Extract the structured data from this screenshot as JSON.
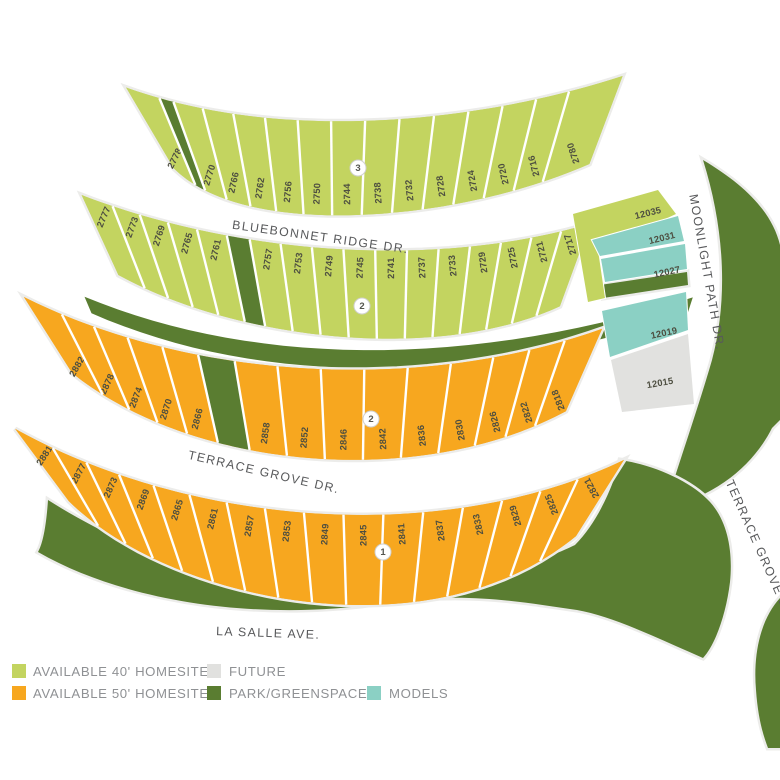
{
  "title": "community-site-map",
  "colors": {
    "lot40": "#c3d460",
    "lot50": "#f7a71f",
    "park": "#5a7d31",
    "model": "#8bd0c4",
    "future": "#e1e1df",
    "roadHalo": "#ececea",
    "divider": "#ffffff",
    "lotText": "#4d4e40",
    "streetText": "#58595b",
    "legendText": "#8f9194",
    "markerFill": "#ffffff",
    "markerStroke": "#d0d0ce",
    "markerText": "#55564f"
  },
  "rows": [
    {
      "name": "row-bluebonnet-north",
      "fillKey": "lot40",
      "halfwidth": 47,
      "labelOffset": 0.55,
      "centerline": [
        [
          150,
          128
        ],
        [
          255,
          190
        ],
        [
          460,
          175
        ],
        [
          606,
          120
        ]
      ],
      "slices": [
        {
          "lot": "2778",
          "w": 1.25
        },
        {
          "park": true,
          "w": 0.5
        },
        {
          "lot": "2770",
          "w": 1
        },
        {
          "lot": "2766",
          "w": 1
        },
        {
          "lot": "2762",
          "w": 1
        },
        {
          "lot": "2756",
          "w": 1
        },
        {
          "lot": "2750",
          "w": 1
        },
        {
          "lot": "2744",
          "w": 1
        },
        {
          "lot": "2738",
          "w": 1
        },
        {
          "lot": "2732",
          "w": 1
        },
        {
          "lot": "2728",
          "w": 1
        },
        {
          "lot": "2724",
          "w": 1
        },
        {
          "lot": "2720",
          "w": 1
        },
        {
          "lot": "2716",
          "w": 1
        },
        {
          "lot": "2780",
          "w": 1.7
        }
      ]
    },
    {
      "name": "row-bluebonnet-south",
      "fillKey": "lot40",
      "halfwidth": 44,
      "labelOffset": -0.6,
      "centerline": [
        [
          100,
          235
        ],
        [
          230,
          295
        ],
        [
          430,
          318
        ],
        [
          575,
          265
        ]
      ],
      "slices": [
        {
          "lot": "2777",
          "w": 1.2
        },
        {
          "lot": "2773",
          "w": 1
        },
        {
          "lot": "2769",
          "w": 1
        },
        {
          "lot": "2765",
          "w": 1
        },
        {
          "lot": "2761",
          "w": 1
        },
        {
          "park": true,
          "w": 0.75
        },
        {
          "lot": "2757",
          "w": 1
        },
        {
          "lot": "2753",
          "w": 1
        },
        {
          "lot": "2749",
          "w": 1
        },
        {
          "lot": "2745",
          "w": 1
        },
        {
          "lot": "2741",
          "w": 1
        },
        {
          "lot": "2737",
          "w": 1
        },
        {
          "lot": "2733",
          "w": 1
        },
        {
          "lot": "2729",
          "w": 1
        },
        {
          "lot": "2725",
          "w": 1
        },
        {
          "lot": "2721",
          "w": 1
        },
        {
          "lot": "2717",
          "w": 1
        }
      ]
    },
    {
      "name": "row-terrace-north",
      "fillKey": "lot50",
      "halfwidth": 45,
      "labelOffset": 0.55,
      "centerline": [
        [
          48,
          335
        ],
        [
          190,
          425
        ],
        [
          420,
          442
        ],
        [
          584,
          370
        ]
      ],
      "slices": [
        {
          "lot": "2882",
          "w": 1.25
        },
        {
          "lot": "2878",
          "w": 1
        },
        {
          "lot": "2874",
          "w": 1
        },
        {
          "lot": "2870",
          "w": 1
        },
        {
          "lot": "2866",
          "w": 1
        },
        {
          "park": true,
          "w": 1.0
        },
        {
          "lot": "2858",
          "w": 1.15
        },
        {
          "lot": "2852",
          "w": 1.15
        },
        {
          "lot": "2846",
          "w": 1.15
        },
        {
          "lot": "2842",
          "w": 1.15
        },
        {
          "lot": "2836",
          "w": 1.15
        },
        {
          "lot": "2830",
          "w": 1.15
        },
        {
          "lot": "2826",
          "w": 1
        },
        {
          "lot": "2822",
          "w": 1
        },
        {
          "lot": "2818",
          "w": 1.1
        }
      ]
    },
    {
      "name": "row-terrace-south",
      "fillKey": "lot50",
      "halfwidth": 45,
      "labelOffset": -0.55,
      "centerline": [
        [
          42,
          465
        ],
        [
          170,
          560
        ],
        [
          430,
          605
        ],
        [
          600,
          498
        ]
      ],
      "slices": [
        {
          "lot": "2881",
          "w": 1.35
        },
        {
          "lot": "2877",
          "w": 1.1
        },
        {
          "lot": "2873",
          "w": 1
        },
        {
          "lot": "2869",
          "w": 1
        },
        {
          "lot": "2865",
          "w": 1
        },
        {
          "lot": "2861",
          "w": 1
        },
        {
          "lot": "2857",
          "w": 1
        },
        {
          "lot": "2853",
          "w": 1
        },
        {
          "lot": "2849",
          "w": 1
        },
        {
          "lot": "2845",
          "w": 1
        },
        {
          "lot": "2841",
          "w": 1
        },
        {
          "lot": "2837",
          "w": 1
        },
        {
          "lot": "2833",
          "w": 1
        },
        {
          "lot": "2829",
          "w": 1
        },
        {
          "lot": "2825",
          "w": 1
        },
        {
          "lot": "2821",
          "w": 1.3
        }
      ]
    }
  ],
  "greenStrip": {
    "halfwidth": 9,
    "centerline": [
      [
        88,
        305
      ],
      [
        250,
        374
      ],
      [
        460,
        380
      ],
      [
        690,
        306
      ]
    ]
  },
  "parks": [
    {
      "name": "park-moonlight-east",
      "d": "M703,160 C725,230 728,300 712,360 C700,402 680,460 665,508 C720,495 755,462 772,428 L780,420 L780,245 C772,212 745,185 703,160 Z"
    },
    {
      "name": "park-south-greenbelt",
      "d": "M48,500 C150,565 280,602 400,592 C480,582 540,562 575,545 C600,520 615,480 620,460 C655,465 692,482 710,502 C728,522 733,552 730,582 C726,615 715,645 703,658 C655,637 612,616 577,610 C520,602 470,592 390,602 C270,622 130,605 38,552 C42,545 46,530 48,500 Z"
    },
    {
      "name": "park-east-edge-sliver",
      "d": "M780,598 C760,620 753,655 756,690 C758,718 763,735 768,748 L780,748 Z"
    },
    {
      "name": "park-strip-models-block",
      "d": "M600,285 L687,272 L688,285 L603,298 Z"
    }
  ],
  "rightBlock": [
    {
      "id": "12035",
      "typeKey": "lot40",
      "points": "573,214 658,190 676,214 598,250 605,298 588,302",
      "label": {
        "x": 648,
        "y": 213,
        "rot": -14
      }
    },
    {
      "id": "12031",
      "typeKey": "model",
      "points": "592,240 678,216 684,241 600,256",
      "label": {
        "x": 662,
        "y": 238,
        "rot": -14
      }
    },
    {
      "id": "12027",
      "typeKey": "model",
      "points": "601,259 685,244 687,269 605,282",
      "label": {
        "x": 667,
        "y": 272,
        "rot": -12
      }
    },
    {
      "id": "12019",
      "typeKey": "model",
      "points": "602,311 686,292 688,330 610,357",
      "label": {
        "x": 664,
        "y": 333,
        "rot": -12
      }
    },
    {
      "id": "12015",
      "typeKey": "future",
      "points": "611,360 688,334 694,404 622,412",
      "label": {
        "x": 660,
        "y": 383,
        "rot": -10
      }
    }
  ],
  "markers": [
    {
      "label": "3",
      "x": 358,
      "y": 168
    },
    {
      "label": "2",
      "x": 362,
      "y": 306
    },
    {
      "label": "2",
      "x": 371,
      "y": 419
    },
    {
      "label": "1",
      "x": 383,
      "y": 552
    }
  ],
  "streets": [
    {
      "name": "BLUEBONNET RIDGE DR.",
      "x": 320,
      "y": 241,
      "rot": 8
    },
    {
      "name": "TERRACE GROVE DR.",
      "x": 263,
      "y": 476,
      "rot": 13
    },
    {
      "name": "LA SALLE AVE.",
      "x": 268,
      "y": 637,
      "rot": 2
    },
    {
      "name": "MOONLIGHT PATH DR.",
      "x": 703,
      "y": 273,
      "rot": 80
    },
    {
      "name": "TERRACE GROVE DR.",
      "x": 757,
      "y": 553,
      "rot": 66
    }
  ],
  "legend": {
    "items": [
      {
        "label": "AVAILABLE 40' HOMESITES",
        "colorKey": "lot40",
        "sx": 12,
        "sy": 664,
        "tx": 33,
        "ty": 676
      },
      {
        "label": "FUTURE",
        "colorKey": "future",
        "sx": 207,
        "sy": 664,
        "tx": 229,
        "ty": 676
      },
      {
        "label": "AVAILABLE 50' HOMESITES",
        "colorKey": "lot50",
        "sx": 12,
        "sy": 686,
        "tx": 33,
        "ty": 698
      },
      {
        "label": "PARK/GREENSPACE",
        "colorKey": "park",
        "sx": 207,
        "sy": 686,
        "tx": 229,
        "ty": 698
      },
      {
        "label": "MODELS",
        "colorKey": "model",
        "sx": 367,
        "sy": 686,
        "tx": 389,
        "ty": 698
      }
    ]
  }
}
